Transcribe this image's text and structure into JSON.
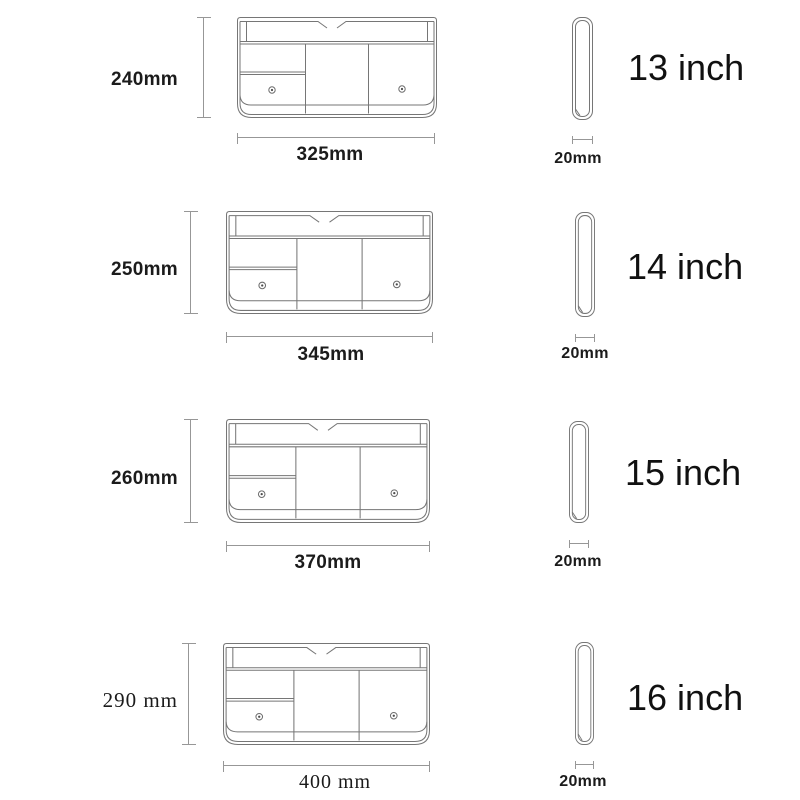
{
  "colors": {
    "background": "#ffffff",
    "drawing_line": "#767676",
    "dimension_line": "#979797",
    "text": "#1b1b1b"
  },
  "rows": [
    {
      "size_label": "13 inch",
      "height_label": "240mm",
      "width_label": "325mm",
      "depth_label": "20mm"
    },
    {
      "size_label": "14 inch",
      "height_label": "250mm",
      "width_label": "345mm",
      "depth_label": "20mm"
    },
    {
      "size_label": "15 inch",
      "height_label": "260mm",
      "width_label": "370mm",
      "depth_label": "20mm"
    },
    {
      "size_label": "16 inch",
      "height_label": "290 mm",
      "width_label": "400 mm",
      "depth_label": "20mm"
    }
  ]
}
